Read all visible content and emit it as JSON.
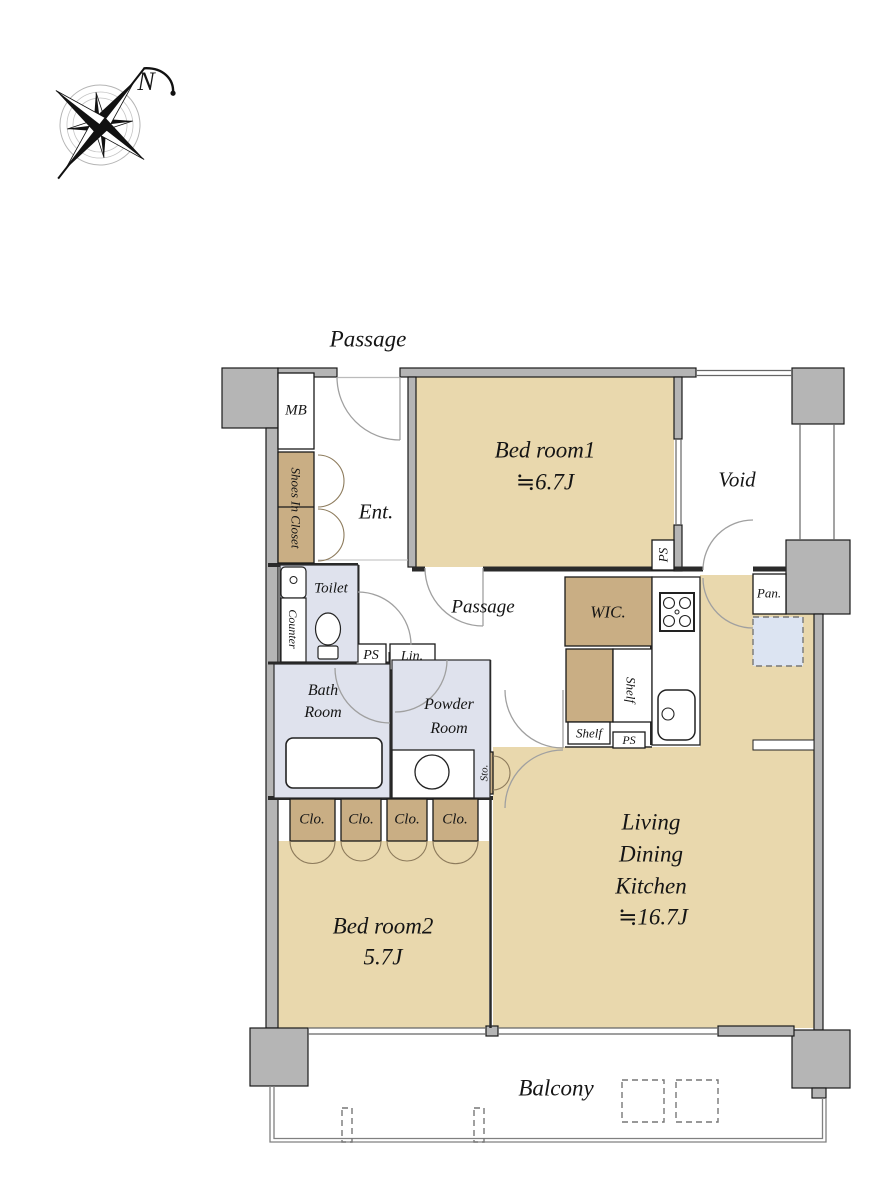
{
  "compass": {
    "north_label": "N"
  },
  "common_areas": {
    "passage_top": "Passage",
    "balcony": "Balcony"
  },
  "rooms": {
    "bedroom1": {
      "name": "Bed room1",
      "size": "≒6.7J"
    },
    "bedroom2": {
      "name": "Bed room2",
      "size": "5.7J"
    },
    "ldk": {
      "line1": "Living",
      "line2": "Dining",
      "line3": "Kitchen",
      "size": "≒16.7J"
    },
    "void": "Void",
    "entrance": "Ent.",
    "passage_inner": "Passage",
    "toilet": "Toilet",
    "bath": {
      "line1": "Bath",
      "line2": "Room"
    },
    "powder": {
      "line1": "Powder",
      "line2": "Room"
    }
  },
  "storage": {
    "shoes_in_closet": "Shoes In Closet",
    "wic": "WIC.",
    "closet": "Clo.",
    "shelf": "Shelf",
    "storage_abbr": "Sto.",
    "pantry": "Pan.",
    "linen": "Lin."
  },
  "utilities": {
    "meter_box": "MB",
    "pipe_space": "PS",
    "counter": "Counter"
  },
  "colors": {
    "floor": "#e9d8ad",
    "closet": "#c9ae84",
    "wet_area": "#dfe2ed",
    "wall": "#b5b5b5",
    "refrigerator": "#dce4f2"
  }
}
